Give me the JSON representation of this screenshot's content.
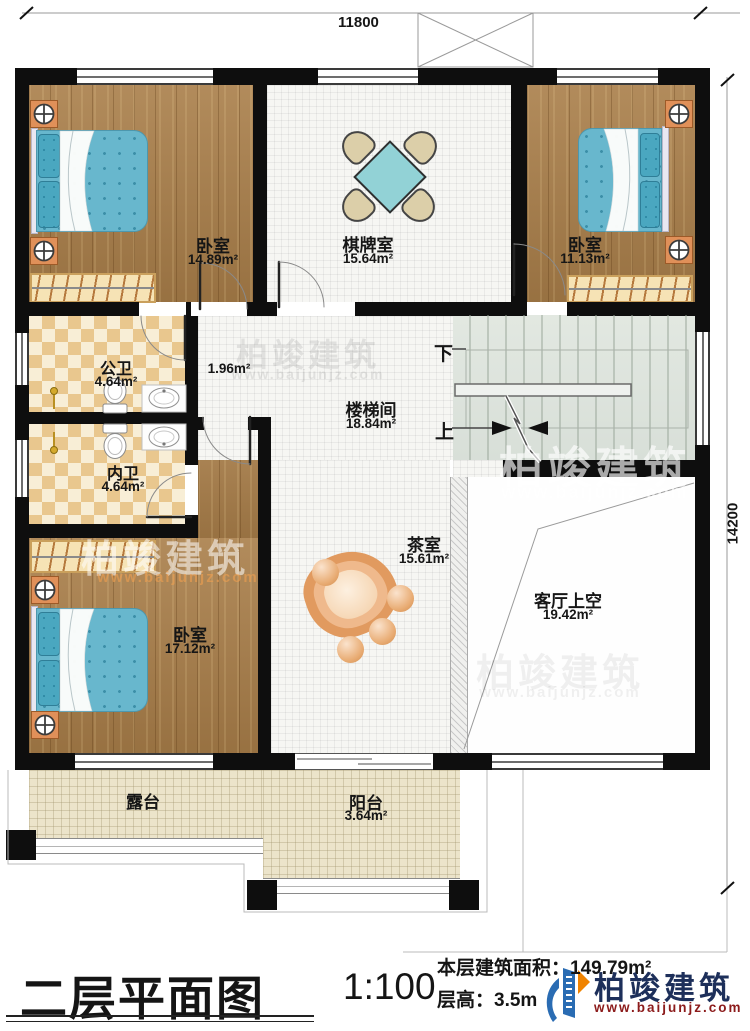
{
  "plan": {
    "name": "二层平面图",
    "scale": "1:100",
    "stats": {
      "area_label": "本层建筑面积：",
      "area_value": "149.79m²",
      "height_label": "层高：",
      "height_value": "3.5m"
    },
    "dimensions": {
      "width": "11800",
      "height": "14200"
    },
    "stairs": {
      "down": "下",
      "up": "上"
    },
    "rooms": [
      {
        "id": "bedroom-top-left",
        "name": "卧室",
        "area": "14.89m²"
      },
      {
        "id": "game-room",
        "name": "棋牌室",
        "area": "15.64m²"
      },
      {
        "id": "bedroom-top-right",
        "name": "卧室",
        "area": "11.13m²"
      },
      {
        "id": "public-bath",
        "name": "公卫",
        "area": "4.64m²"
      },
      {
        "id": "hall-nook",
        "name": "",
        "area": "1.96m²"
      },
      {
        "id": "ensuite-bath",
        "name": "内卫",
        "area": "4.64m²"
      },
      {
        "id": "stair-hall",
        "name": "楼梯间",
        "area": "18.84m²"
      },
      {
        "id": "tea-room",
        "name": "茶室",
        "area": "15.61m²"
      },
      {
        "id": "bedroom-bottom-left",
        "name": "卧室",
        "area": "17.12m²"
      },
      {
        "id": "living-void",
        "name": "客厅上空",
        "area": "19.42m²"
      },
      {
        "id": "terrace",
        "name": "露台",
        "area": ""
      },
      {
        "id": "balcony",
        "name": "阳台",
        "area": "3.64m²"
      }
    ],
    "watermark": {
      "brand": "柏竣建筑",
      "url": "www.baijunjz.com"
    },
    "brand": {
      "name": "柏竣建筑",
      "url": "www.baijunjz.com"
    },
    "colors": {
      "wall": "#0e0e0e",
      "wood_floor": "#a97e49",
      "bathroom_tile": "#e9c78e",
      "stair_fill": "#dde3dc",
      "terrace_tile": "#ece4ca",
      "bed_blue": "#68b7cd",
      "table_teal": "#92d2d6",
      "logo_navy": "#1d2f5a",
      "logo_red": "#8c1b1b",
      "logo_blue": "#2a6cb3",
      "logo_orange": "#f08300"
    }
  }
}
